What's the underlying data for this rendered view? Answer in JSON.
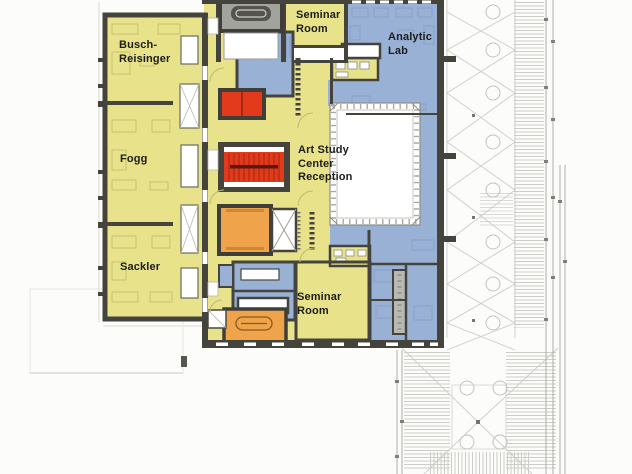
{
  "labels": {
    "busch_reisinger": {
      "l1": "Busch-",
      "l2": "Reisinger"
    },
    "fogg": {
      "l1": "Fogg"
    },
    "sackler": {
      "l1": "Sackler"
    },
    "seminar_room_top": {
      "l1": "Seminar",
      "l2": "Room"
    },
    "analytic_lab": {
      "l1": "Analytic",
      "l2": "Lab"
    },
    "art_study_center": {
      "l1": "Art Study",
      "l2": "Center",
      "l3": "Reception"
    },
    "seminar_room_bottom": {
      "l1": "Seminar",
      "l2": "Room"
    }
  },
  "colors": {
    "gallery_yellow": "#e8e28b",
    "support_blue": "#9ab1d6",
    "stair_red": "#e23a1a",
    "elevator_orange": "#efa34b",
    "wall_dark": "#45443c",
    "roof_line_gray": "#ccccc8"
  }
}
